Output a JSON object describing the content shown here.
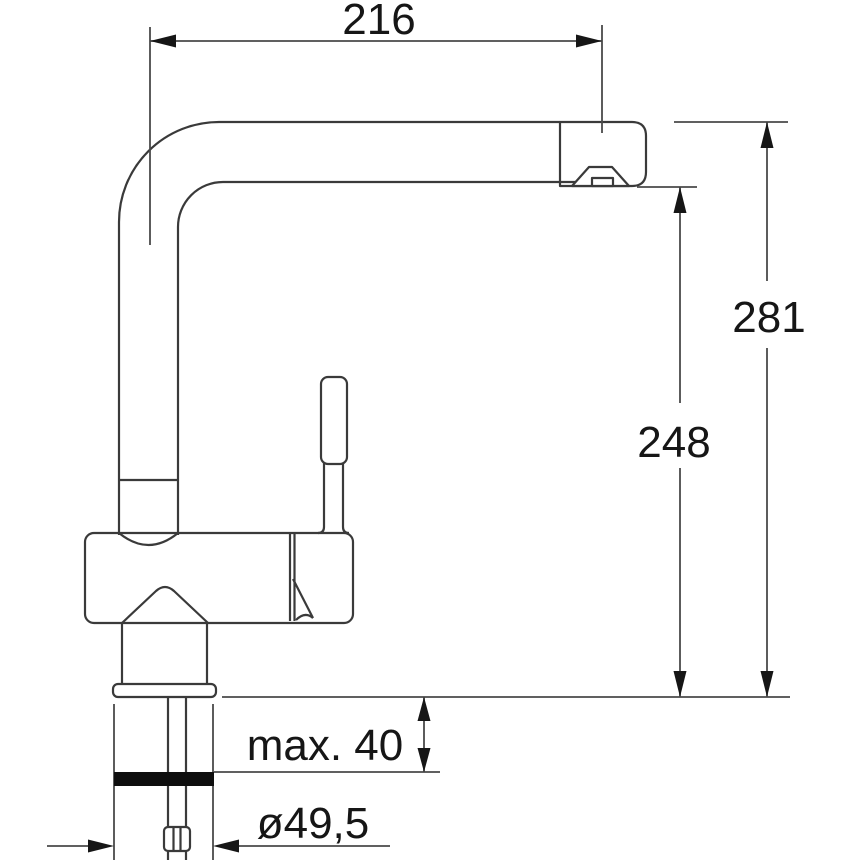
{
  "colors": {
    "background": "#ffffff",
    "line": "#3a3a3a",
    "dimline": "#4a4a4a",
    "text": "#161616",
    "gasket": "#0e0e0e"
  },
  "dimensions": {
    "spout_reach_label": "216",
    "overall_height_label": "281",
    "outlet_height_label": "248",
    "mounting_thickness_label": "max. 40",
    "hole_diameter_label": "ø49,5"
  }
}
